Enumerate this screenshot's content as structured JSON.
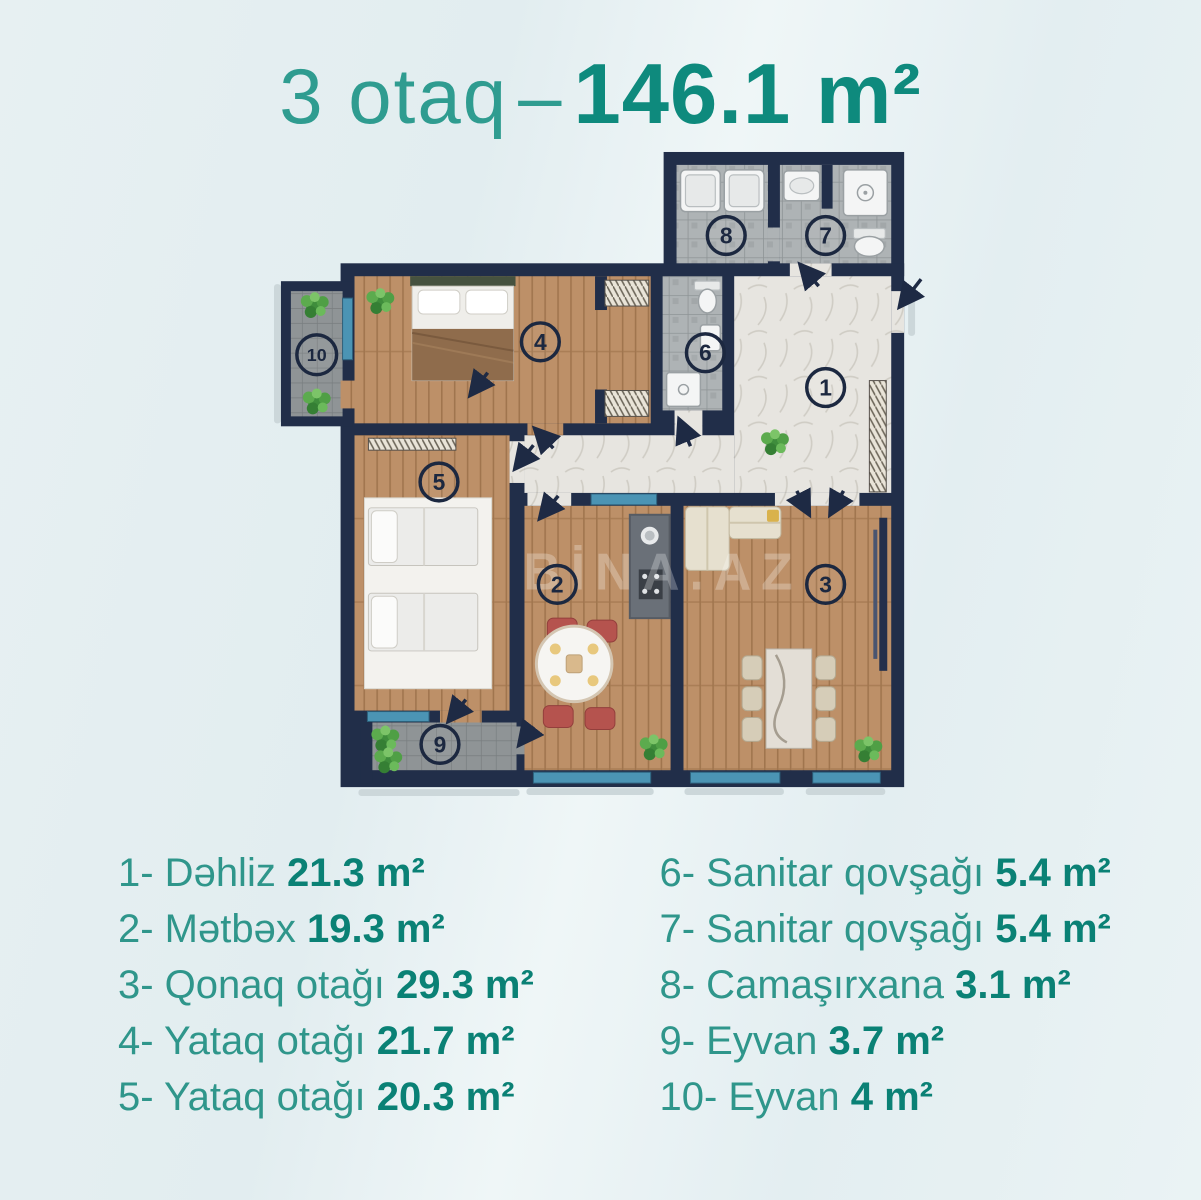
{
  "title": {
    "rooms": "3 otaq",
    "separator": "–",
    "area": "146.1 m²"
  },
  "watermark": "BİNA.AZ",
  "legend": {
    "left": [
      {
        "num": "1-",
        "name": "Dəhliz",
        "area": "21.3 m²"
      },
      {
        "num": "2-",
        "name": "Mətbəx",
        "area": "19.3 m²"
      },
      {
        "num": "3-",
        "name": "Qonaq otağı",
        "area": "29.3 m²"
      },
      {
        "num": "4-",
        "name": "Yataq otağı",
        "area": "21.7 m²"
      },
      {
        "num": "5-",
        "name": "Yataq otağı",
        "area": "20.3 m²"
      }
    ],
    "right": [
      {
        "num": "6-",
        "name": "Sanitar qovşağı",
        "area": "5.4 m²"
      },
      {
        "num": "7-",
        "name": "Sanitar qovşağı",
        "area": "5.4 m²"
      },
      {
        "num": "8-",
        "name": "Camaşırxana",
        "area": "3.1 m²"
      },
      {
        "num": "9-",
        "name": "Eyvan",
        "area": "3.7 m²"
      },
      {
        "num": "10-",
        "name": "Eyvan",
        "area": "4 m²"
      }
    ]
  },
  "plan": {
    "room_markers": [
      {
        "label": "1",
        "x": 556,
        "y": 245
      },
      {
        "label": "2",
        "x": 286,
        "y": 443
      },
      {
        "label": "3",
        "x": 556,
        "y": 443
      },
      {
        "label": "4",
        "x": 269,
        "y": 199
      },
      {
        "label": "5",
        "x": 167,
        "y": 340
      },
      {
        "label": "6",
        "x": 435,
        "y": 210
      },
      {
        "label": "7",
        "x": 556,
        "y": 92
      },
      {
        "label": "8",
        "x": 456,
        "y": 92
      },
      {
        "label": "9",
        "x": 168,
        "y": 604
      },
      {
        "label": "10",
        "x": 44,
        "y": 212
      }
    ]
  },
  "colors": {
    "title_light": "#2f9c90",
    "title_bold": "#0e8a7d",
    "legend_name": "#2f968b",
    "legend_area": "#0a8175",
    "wall": "#212e49",
    "window": "#4b94b4",
    "wood_floor": "#bd9068",
    "tile_floor": "#aeb3b5",
    "marble_floor": "#e7e5e0"
  }
}
